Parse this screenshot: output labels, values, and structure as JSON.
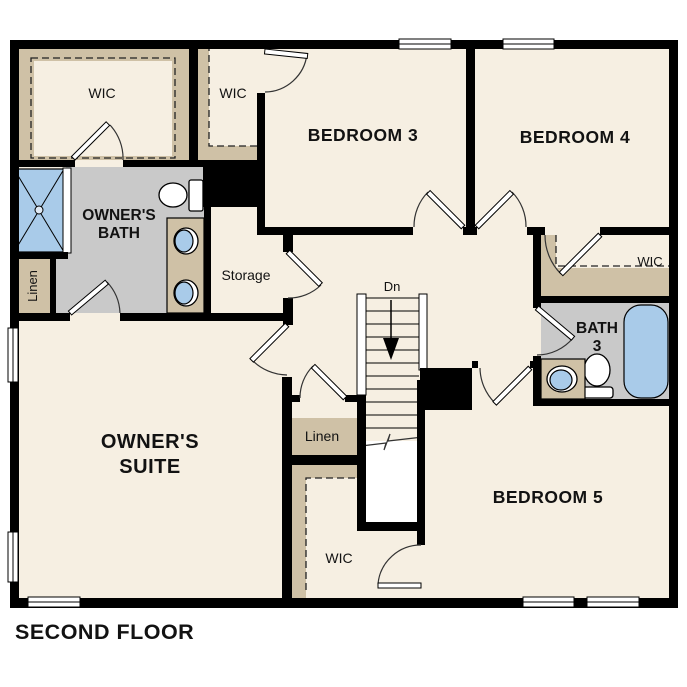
{
  "title": "SECOND FLOOR",
  "colors": {
    "background": "#ffffff",
    "wall": "#000000",
    "floor": "#f6efe2",
    "shelf_tan": "#cfc1a6",
    "bath_gray": "#c9c9c9",
    "fixture_blue": "#a9cbe9"
  },
  "labels": {
    "owners_wic": "WIC",
    "bedroom3_wic": "WIC",
    "bedroom3": "BEDROOM 3",
    "bedroom4": "BEDROOM 4",
    "owners_bath": [
      "OWNER'S",
      "BATH"
    ],
    "bath_linen": "Linen",
    "storage": "Storage",
    "stairs_down": "Dn",
    "bedroom4_wic": "WIC",
    "bath3": [
      "BATH",
      "3"
    ],
    "owners_suite": [
      "OWNER'S",
      "SUITE"
    ],
    "hall_linen": "Linen",
    "bedroom5_wic": "WIC",
    "bedroom5": "BEDROOM 5"
  }
}
